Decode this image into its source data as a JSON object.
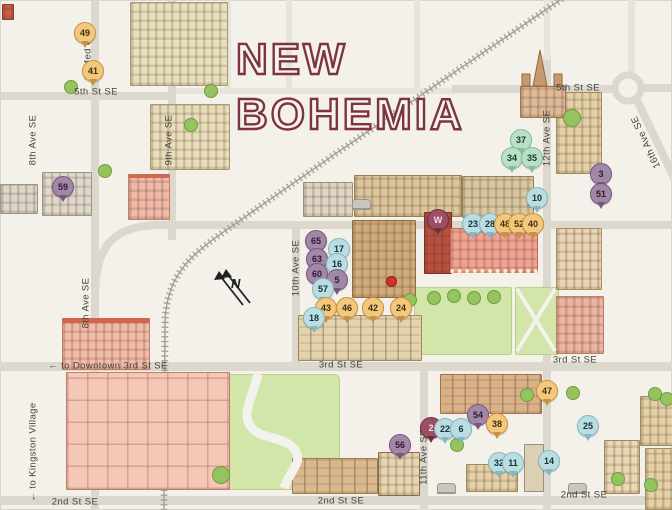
{
  "title": {
    "line1": "NEW",
    "line2": "BOHEMIA"
  },
  "compass": {
    "label": "N"
  },
  "map": {
    "street_labels": [
      {
        "text": "to Med Q →",
        "x": 88,
        "y": 52,
        "rot": -90
      },
      {
        "text": "5th St SE",
        "x": 96,
        "y": 92,
        "rot": 0
      },
      {
        "text": "8th Ave SE",
        "x": 33,
        "y": 140,
        "rot": -90
      },
      {
        "text": "9th Ave SE",
        "x": 169,
        "y": 140,
        "rot": -90
      },
      {
        "text": "5th St SE",
        "x": 578,
        "y": 88,
        "rot": 0
      },
      {
        "text": "12th Ave SE",
        "x": 547,
        "y": 138,
        "rot": -90
      },
      {
        "text": "16th Ave SE",
        "x": 646,
        "y": 142,
        "rot": -115
      },
      {
        "text": "10th Ave SE",
        "x": 296,
        "y": 268,
        "rot": -90
      },
      {
        "text": "8th Ave SE",
        "x": 86,
        "y": 303,
        "rot": -90
      },
      {
        "text": "← to Downtown  3rd St SE",
        "x": 108,
        "y": 366,
        "rot": 0
      },
      {
        "text": "3rd St SE",
        "x": 341,
        "y": 365,
        "rot": 0
      },
      {
        "text": "3rd St SE",
        "x": 575,
        "y": 360,
        "rot": 0
      },
      {
        "text": "← to Kingston Village",
        "x": 33,
        "y": 452,
        "rot": -90
      },
      {
        "text": "11th Ave SE",
        "x": 424,
        "y": 457,
        "rot": -90
      },
      {
        "text": "2nd St SE",
        "x": 75,
        "y": 502,
        "rot": 0
      },
      {
        "text": "2nd St SE",
        "x": 341,
        "y": 501,
        "rot": 0
      },
      {
        "text": "2nd St SE",
        "x": 584,
        "y": 495,
        "rot": 0
      }
    ],
    "markers": [
      {
        "label": "49",
        "x": 84,
        "y": 32,
        "color": "orange"
      },
      {
        "label": "41",
        "x": 92,
        "y": 70,
        "color": "orange"
      },
      {
        "label": "59",
        "x": 62,
        "y": 186,
        "color": "purple"
      },
      {
        "label": "37",
        "x": 520,
        "y": 139,
        "color": "green"
      },
      {
        "label": "34",
        "x": 511,
        "y": 157,
        "color": "green"
      },
      {
        "label": "35",
        "x": 531,
        "y": 157,
        "color": "green"
      },
      {
        "label": "3",
        "x": 600,
        "y": 173,
        "color": "purple"
      },
      {
        "label": "51",
        "x": 600,
        "y": 193,
        "color": "purple"
      },
      {
        "label": "10",
        "x": 536,
        "y": 197,
        "color": "blue"
      },
      {
        "label": "W",
        "x": 437,
        "y": 219,
        "color": "maroon"
      },
      {
        "label": "23",
        "x": 472,
        "y": 223,
        "color": "blue"
      },
      {
        "label": "28",
        "x": 489,
        "y": 223,
        "color": "blue"
      },
      {
        "label": "48",
        "x": 504,
        "y": 223,
        "color": "orange"
      },
      {
        "label": "52",
        "x": 518,
        "y": 223,
        "color": "orange"
      },
      {
        "label": "40",
        "x": 532,
        "y": 223,
        "color": "orange"
      },
      {
        "label": "65",
        "x": 315,
        "y": 240,
        "color": "purple"
      },
      {
        "label": "17",
        "x": 338,
        "y": 248,
        "color": "blue"
      },
      {
        "label": "63",
        "x": 316,
        "y": 258,
        "color": "purple"
      },
      {
        "label": "16",
        "x": 336,
        "y": 263,
        "color": "blue"
      },
      {
        "label": "60",
        "x": 316,
        "y": 273,
        "color": "purple"
      },
      {
        "label": "5",
        "x": 336,
        "y": 279,
        "color": "purple"
      },
      {
        "label": "57",
        "x": 322,
        "y": 288,
        "color": "blue"
      },
      {
        "label": "43",
        "x": 325,
        "y": 307,
        "color": "orange"
      },
      {
        "label": "46",
        "x": 346,
        "y": 307,
        "color": "orange"
      },
      {
        "label": "42",
        "x": 372,
        "y": 307,
        "color": "orange"
      },
      {
        "label": "24",
        "x": 400,
        "y": 307,
        "color": "orange"
      },
      {
        "label": "18",
        "x": 313,
        "y": 317,
        "color": "blue"
      },
      {
        "label": "47",
        "x": 546,
        "y": 390,
        "color": "orange"
      },
      {
        "label": "54",
        "x": 477,
        "y": 414,
        "color": "purple"
      },
      {
        "label": "38",
        "x": 496,
        "y": 423,
        "color": "orange"
      },
      {
        "label": "25",
        "x": 587,
        "y": 425,
        "color": "blue"
      },
      {
        "label": "2",
        "x": 430,
        "y": 427,
        "color": "maroon"
      },
      {
        "label": "22",
        "x": 444,
        "y": 428,
        "color": "blue"
      },
      {
        "label": "6",
        "x": 460,
        "y": 428,
        "color": "blue"
      },
      {
        "label": "56",
        "x": 399,
        "y": 444,
        "color": "purple"
      },
      {
        "label": "32",
        "x": 498,
        "y": 462,
        "color": "blue"
      },
      {
        "label": "11",
        "x": 512,
        "y": 462,
        "color": "blue"
      },
      {
        "label": "14",
        "x": 548,
        "y": 460,
        "color": "blue"
      }
    ],
    "palette": {
      "orange": "#f3c87c",
      "blue": "#badde1",
      "green": "#b9e0c6",
      "purple": "#a287a7",
      "maroon": "#9c4f63",
      "street": "#dcd8ce",
      "park": "#d3e6a9",
      "background": "#f3f1ea",
      "title_outline": "#7d3246"
    }
  }
}
